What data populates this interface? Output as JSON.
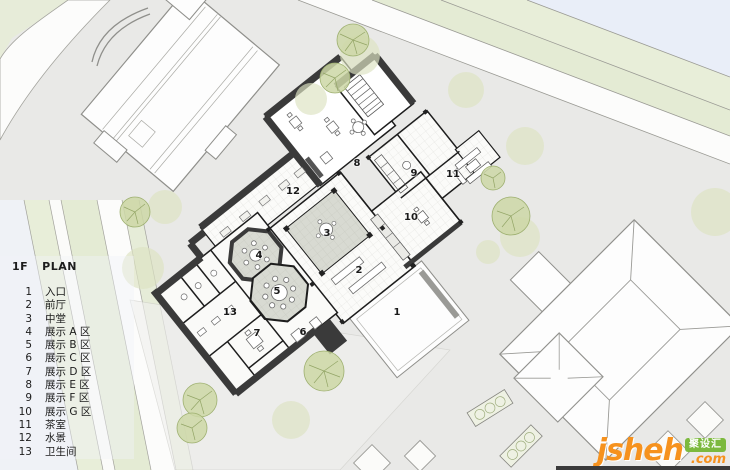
{
  "legend": {
    "floor": "1F",
    "plan_word": "PLAN",
    "items": [
      {
        "no": "1",
        "label": "入口"
      },
      {
        "no": "2",
        "label": "前厅"
      },
      {
        "no": "3",
        "label": "中堂"
      },
      {
        "no": "4",
        "label": "展示 A 区"
      },
      {
        "no": "5",
        "label": "展示 B 区"
      },
      {
        "no": "6",
        "label": "展示 C 区"
      },
      {
        "no": "7",
        "label": "展示 D 区"
      },
      {
        "no": "8",
        "label": "展示 E 区"
      },
      {
        "no": "9",
        "label": "展示 F 区"
      },
      {
        "no": "10",
        "label": "展示 G 区"
      },
      {
        "no": "11",
        "label": "茶室"
      },
      {
        "no": "12",
        "label": "水景"
      },
      {
        "no": "13",
        "label": "卫生间"
      }
    ]
  },
  "plan": {
    "room_numbers": [
      "1",
      "2",
      "3",
      "4",
      "5",
      "6",
      "7",
      "8",
      "9",
      "10",
      "11",
      "12",
      "13"
    ]
  },
  "watermark": {
    "brand": "jsheh",
    "badge": "聚设汇",
    "suffix": ".com"
  },
  "colors": {
    "site_gray": "#e9e9e7",
    "road_white": "#fcfcfb",
    "verge_green": "#e7ecd9",
    "corner_blue": "#e9eef8",
    "tree_pale": "#dde3c2",
    "tree_detailed": "#cdd7a6",
    "wall_dark": "#3a3a3a",
    "brand_orange": "#f6921e",
    "brand_green": "#7cb93e"
  }
}
